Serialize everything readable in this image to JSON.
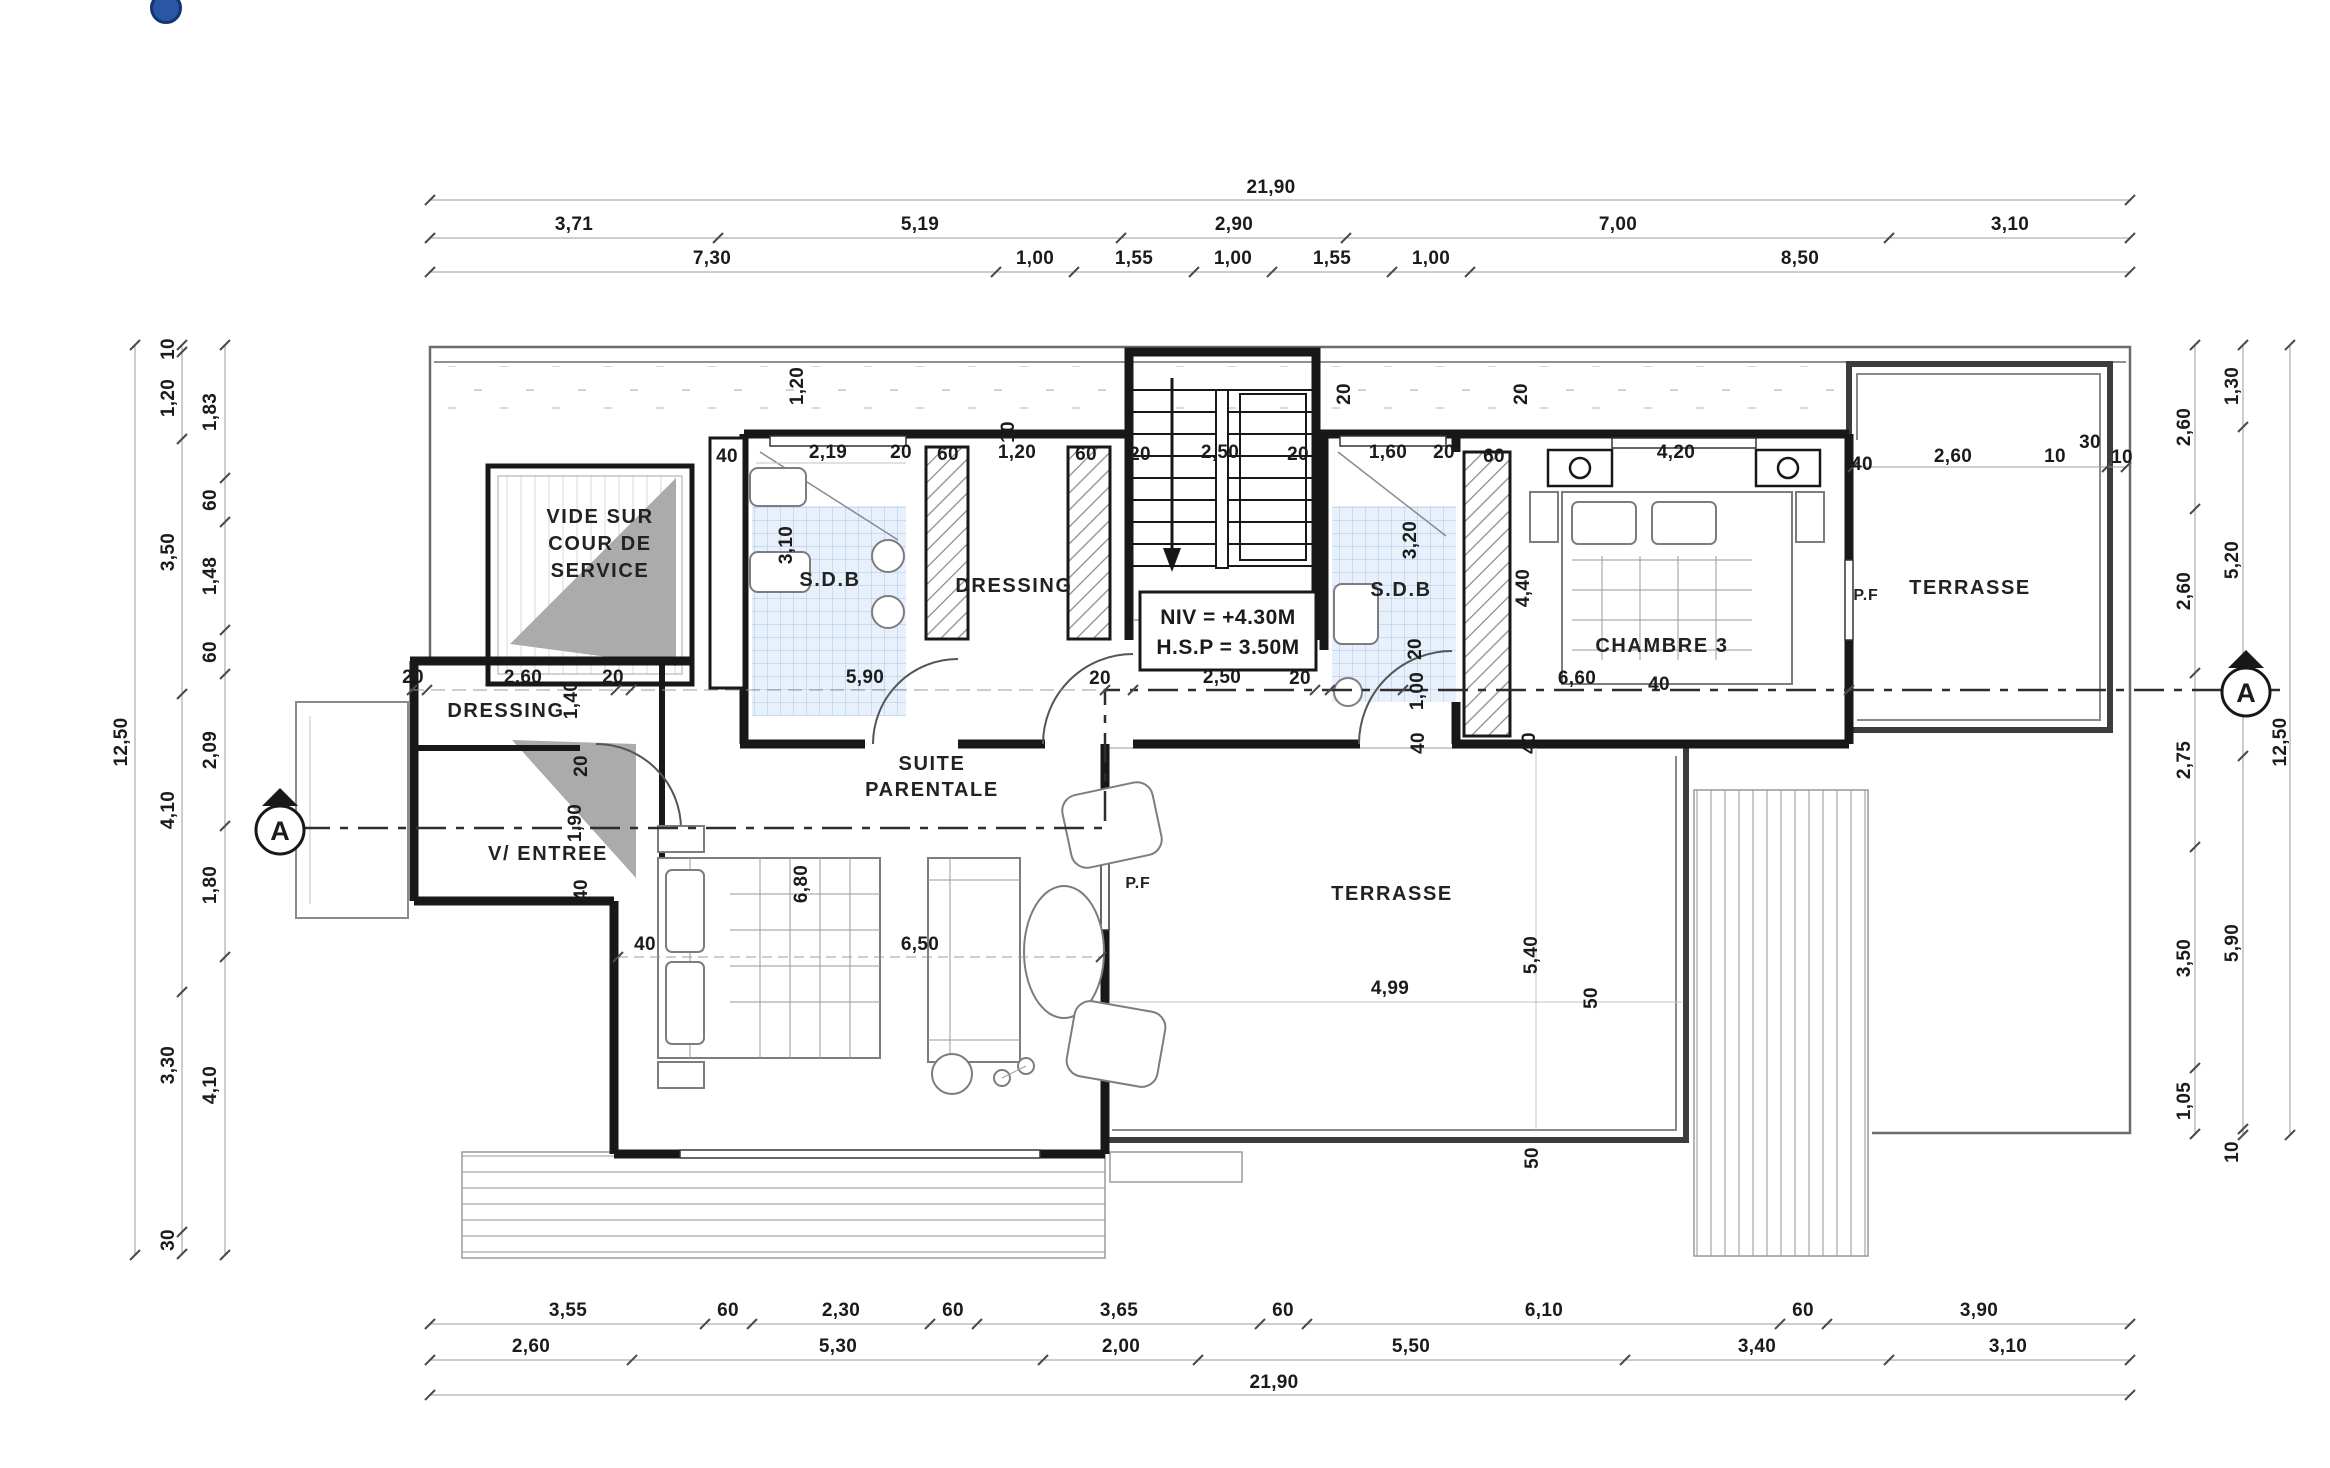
{
  "page": {
    "background": "#ffffff",
    "logo_color": "#2b56a4"
  },
  "level_box": {
    "line1": "NIV = +4.30M",
    "line2": "H.S.P = 3.50M"
  },
  "section_marker": {
    "label": "A"
  },
  "window_labels": [
    {
      "t": "P.F",
      "x": 1866,
      "y": 600
    },
    {
      "t": "P.F",
      "x": 1138,
      "y": 888
    }
  ],
  "room_labels": [
    {
      "lines": [
        "VIDE SUR",
        "COUR DE",
        "SERVICE"
      ],
      "x": 600,
      "y": 523,
      "lh": 27
    },
    {
      "lines": [
        "S.D.B"
      ],
      "x": 830,
      "y": 586,
      "lh": 26
    },
    {
      "lines": [
        "DRESSING"
      ],
      "x": 1014,
      "y": 592,
      "lh": 26
    },
    {
      "lines": [
        "S.D.B"
      ],
      "x": 1401,
      "y": 596,
      "lh": 26
    },
    {
      "lines": [
        "CHAMBRE 3"
      ],
      "x": 1662,
      "y": 652,
      "lh": 26
    },
    {
      "lines": [
        "TERRASSE"
      ],
      "x": 1970,
      "y": 594,
      "lh": 26
    },
    {
      "lines": [
        "DRESSING"
      ],
      "x": 506,
      "y": 717,
      "lh": 24
    },
    {
      "lines": [
        "V/ ENTREE"
      ],
      "x": 548,
      "y": 860,
      "lh": 24
    },
    {
      "lines": [
        "SUITE",
        "PARENTALE"
      ],
      "x": 932,
      "y": 770,
      "lh": 26
    },
    {
      "lines": [
        "TERRASSE"
      ],
      "x": 1392,
      "y": 900,
      "lh": 26
    }
  ],
  "dim_labels": [
    {
      "t": "21,90",
      "x": 1271,
      "y": 193
    },
    {
      "t": "3,71",
      "x": 574,
      "y": 230
    },
    {
      "t": "5,19",
      "x": 920,
      "y": 230
    },
    {
      "t": "2,90",
      "x": 1234,
      "y": 230
    },
    {
      "t": "7,00",
      "x": 1618,
      "y": 230
    },
    {
      "t": "3,10",
      "x": 2010,
      "y": 230
    },
    {
      "t": "7,30",
      "x": 712,
      "y": 264
    },
    {
      "t": "1,00",
      "x": 1035,
      "y": 264
    },
    {
      "t": "1,55",
      "x": 1134,
      "y": 264
    },
    {
      "t": "1,00",
      "x": 1233,
      "y": 264
    },
    {
      "t": "1,55",
      "x": 1332,
      "y": 264
    },
    {
      "t": "1,00",
      "x": 1431,
      "y": 264
    },
    {
      "t": "8,50",
      "x": 1800,
      "y": 264
    },
    {
      "t": "3,55",
      "x": 568,
      "y": 1316
    },
    {
      "t": "60",
      "x": 728,
      "y": 1316
    },
    {
      "t": "2,30",
      "x": 841,
      "y": 1316
    },
    {
      "t": "60",
      "x": 953,
      "y": 1316
    },
    {
      "t": "3,65",
      "x": 1119,
      "y": 1316
    },
    {
      "t": "60",
      "x": 1283,
      "y": 1316
    },
    {
      "t": "6,10",
      "x": 1544,
      "y": 1316
    },
    {
      "t": "60",
      "x": 1803,
      "y": 1316
    },
    {
      "t": "3,90",
      "x": 1979,
      "y": 1316
    },
    {
      "t": "2,60",
      "x": 531,
      "y": 1352
    },
    {
      "t": "5,30",
      "x": 838,
      "y": 1352
    },
    {
      "t": "2,00",
      "x": 1121,
      "y": 1352
    },
    {
      "t": "5,50",
      "x": 1411,
      "y": 1352
    },
    {
      "t": "3,40",
      "x": 1757,
      "y": 1352
    },
    {
      "t": "3,10",
      "x": 2008,
      "y": 1352
    },
    {
      "t": "21,90",
      "x": 1274,
      "y": 1388
    },
    {
      "t": "12,50",
      "x": 127,
      "y": 742,
      "r": 1
    },
    {
      "t": "10",
      "x": 174,
      "y": 349,
      "r": 1
    },
    {
      "t": "1,20",
      "x": 174,
      "y": 398,
      "r": 1
    },
    {
      "t": "3,50",
      "x": 174,
      "y": 552,
      "r": 1
    },
    {
      "t": "4,10",
      "x": 174,
      "y": 810,
      "r": 1
    },
    {
      "t": "3,30",
      "x": 174,
      "y": 1065,
      "r": 1
    },
    {
      "t": "30",
      "x": 174,
      "y": 1240,
      "r": 1
    },
    {
      "t": "1,83",
      "x": 216,
      "y": 412,
      "r": 1
    },
    {
      "t": "60",
      "x": 216,
      "y": 500,
      "r": 1
    },
    {
      "t": "1,48",
      "x": 216,
      "y": 576,
      "r": 1
    },
    {
      "t": "60",
      "x": 216,
      "y": 652,
      "r": 1
    },
    {
      "t": "2,09",
      "x": 216,
      "y": 750,
      "r": 1
    },
    {
      "t": "1,80",
      "x": 216,
      "y": 885,
      "r": 1
    },
    {
      "t": "4,10",
      "x": 216,
      "y": 1085,
      "r": 1
    },
    {
      "t": "2,60",
      "x": 2190,
      "y": 427,
      "r": 1
    },
    {
      "t": "2,60",
      "x": 2190,
      "y": 591,
      "r": 1
    },
    {
      "t": "2,75",
      "x": 2190,
      "y": 760,
      "r": 1
    },
    {
      "t": "3,50",
      "x": 2190,
      "y": 958,
      "r": 1
    },
    {
      "t": "1,05",
      "x": 2190,
      "y": 1101,
      "r": 1
    },
    {
      "t": "1,30",
      "x": 2238,
      "y": 386,
      "r": 1
    },
    {
      "t": "5,20",
      "x": 2238,
      "y": 560,
      "r": 1
    },
    {
      "t": "5,90",
      "x": 2238,
      "y": 943,
      "r": 1
    },
    {
      "t": "10",
      "x": 2238,
      "y": 1152,
      "r": 1
    },
    {
      "t": "12,50",
      "x": 2286,
      "y": 742,
      "r": 1
    },
    {
      "t": "40",
      "x": 727,
      "y": 462
    },
    {
      "t": "2,19",
      "x": 828,
      "y": 458
    },
    {
      "t": "20",
      "x": 901,
      "y": 458
    },
    {
      "t": "60",
      "x": 948,
      "y": 460
    },
    {
      "t": "1,20",
      "x": 1017,
      "y": 458
    },
    {
      "t": "60",
      "x": 1086,
      "y": 460
    },
    {
      "t": "20",
      "x": 1140,
      "y": 460
    },
    {
      "t": "2,50",
      "x": 1220,
      "y": 458
    },
    {
      "t": "20",
      "x": 1298,
      "y": 460
    },
    {
      "t": "1,60",
      "x": 1388,
      "y": 458
    },
    {
      "t": "20",
      "x": 1444,
      "y": 458
    },
    {
      "t": "60",
      "x": 1494,
      "y": 462
    },
    {
      "t": "4,20",
      "x": 1676,
      "y": 458
    },
    {
      "t": "40",
      "x": 1862,
      "y": 470
    },
    {
      "t": "2,60",
      "x": 1953,
      "y": 462
    },
    {
      "t": "10",
      "x": 2055,
      "y": 462
    },
    {
      "t": "30",
      "x": 2090,
      "y": 448
    },
    {
      "t": "10",
      "x": 2122,
      "y": 463
    },
    {
      "t": "20",
      "x": 413,
      "y": 683
    },
    {
      "t": "2,60",
      "x": 523,
      "y": 683
    },
    {
      "t": "20",
      "x": 613,
      "y": 683
    },
    {
      "t": "5,90",
      "x": 865,
      "y": 683
    },
    {
      "t": "20",
      "x": 1100,
      "y": 684
    },
    {
      "t": "2,50",
      "x": 1222,
      "y": 683
    },
    {
      "t": "20",
      "x": 1300,
      "y": 684
    },
    {
      "t": "6,60",
      "x": 1577,
      "y": 684
    },
    {
      "t": "40",
      "x": 1659,
      "y": 690
    },
    {
      "t": "6,50",
      "x": 920,
      "y": 950
    },
    {
      "t": "4,99",
      "x": 1390,
      "y": 994
    },
    {
      "t": "40",
      "x": 645,
      "y": 950
    },
    {
      "t": "1,20",
      "x": 803,
      "y": 386,
      "r": 1
    },
    {
      "t": "10",
      "x": 1014,
      "y": 432,
      "r": 1
    },
    {
      "t": "20",
      "x": 1350,
      "y": 394,
      "r": 1
    },
    {
      "t": "20",
      "x": 1527,
      "y": 394,
      "r": 1
    },
    {
      "t": "3,10",
      "x": 792,
      "y": 545,
      "r": 1
    },
    {
      "t": "3,20",
      "x": 1416,
      "y": 540,
      "r": 1
    },
    {
      "t": "20",
      "x": 1421,
      "y": 649,
      "r": 1
    },
    {
      "t": "4,40",
      "x": 1529,
      "y": 588,
      "r": 1
    },
    {
      "t": "1,40",
      "x": 577,
      "y": 700,
      "r": 1
    },
    {
      "t": "20",
      "x": 587,
      "y": 766,
      "r": 1
    },
    {
      "t": "1,90",
      "x": 581,
      "y": 823,
      "r": 1
    },
    {
      "t": "40",
      "x": 587,
      "y": 890,
      "r": 1
    },
    {
      "t": "6,80",
      "x": 807,
      "y": 884,
      "r": 1
    },
    {
      "t": "1,00",
      "x": 1423,
      "y": 691,
      "r": 1
    },
    {
      "t": "40",
      "x": 1424,
      "y": 743,
      "r": 1
    },
    {
      "t": "40",
      "x": 1535,
      "y": 743,
      "r": 1
    },
    {
      "t": "5,40",
      "x": 1537,
      "y": 955,
      "r": 1
    },
    {
      "t": "50",
      "x": 1597,
      "y": 998,
      "r": 1
    },
    {
      "t": "50",
      "x": 1538,
      "y": 1158,
      "r": 1
    }
  ]
}
